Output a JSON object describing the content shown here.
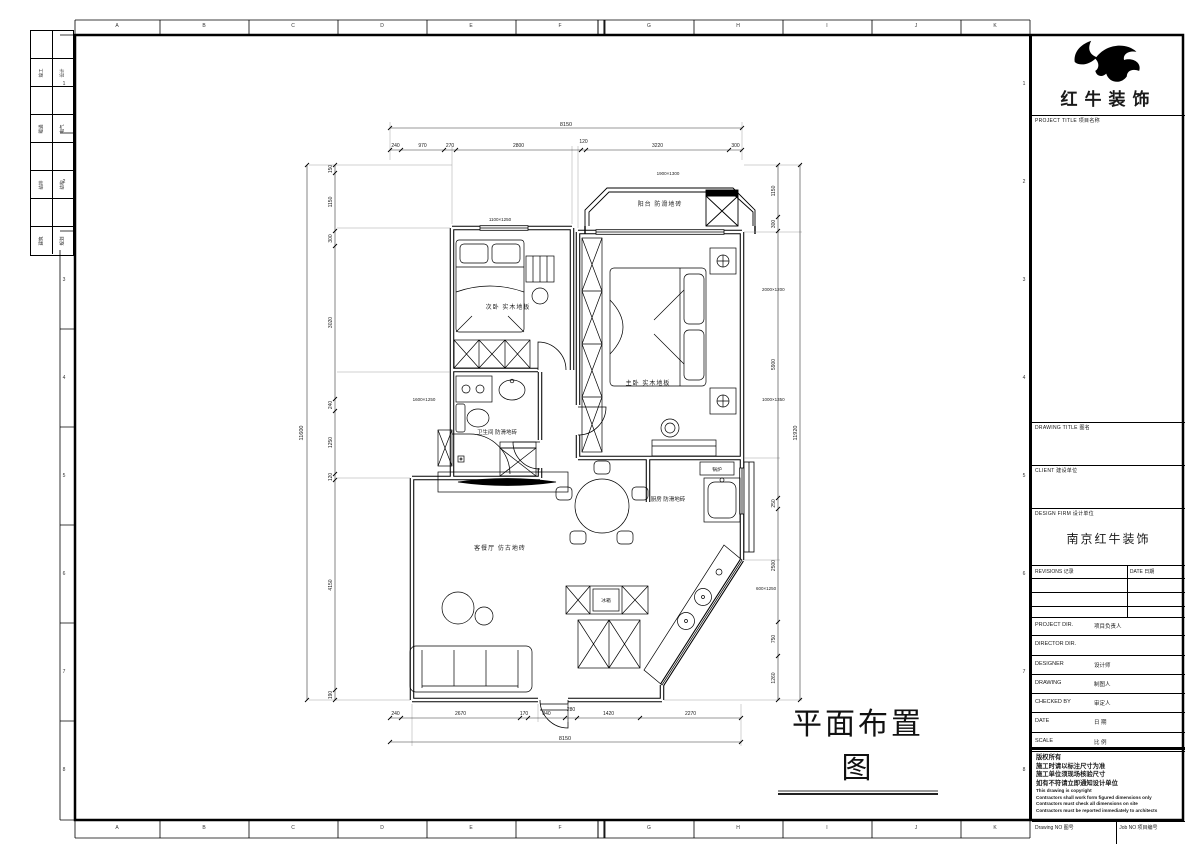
{
  "sheet": {
    "letters": [
      "A",
      "B",
      "C",
      "D",
      "E",
      "F",
      "G",
      "H",
      "I",
      "J",
      "K"
    ],
    "numbers": [
      "1",
      "2",
      "3",
      "4",
      "5",
      "6",
      "7",
      "8"
    ]
  },
  "strip": {
    "pairs": [
      {
        "a": "竣工",
        "b": "设计"
      },
      {
        "a": "暖通",
        "b": "电气"
      },
      {
        "a": "给排",
        "b": "结构"
      },
      {
        "a": "建筑",
        "b": "规划"
      }
    ]
  },
  "logo": {
    "company": "红牛装饰"
  },
  "titleblock": {
    "project_title": "PROJECT TITLE  项目名称",
    "drawing_title": "DRAWING TITLE  图名",
    "client": "CLIENT  建设单位",
    "design_firm": "DESIGN FIRM  设计单位",
    "design_firm_name": "南京红牛装饰",
    "revisions": "REVISIONS  记录",
    "date_col": "DATE  日期",
    "rows": [
      {
        "en": "PROJECT DIR.",
        "cn": "项目负责人"
      },
      {
        "en": "DIRECTOR DIR.",
        "cn": ""
      },
      {
        "en": "DESIGNER",
        "cn": "设计师"
      },
      {
        "en": "DRAWING",
        "cn": "制图人"
      },
      {
        "en": "CHECKED BY",
        "cn": "审定人"
      },
      {
        "en": "DATE",
        "cn": "日  期"
      },
      {
        "en": "SCALE",
        "cn": "比  例"
      }
    ],
    "notes": [
      "版权所有",
      "施工时请以标注尺寸为准",
      "施工单位须现场核验尺寸",
      "如有不符请立即通知设计单位",
      "This drawing is copyright",
      "Contractors shall work form figured dimensions only",
      "Contractors must check all dimensions on site",
      "Contractors must be reported immediately to architects"
    ],
    "drawing_no": "Drawing NO  图号",
    "job_no": "Job NO  项目编号"
  },
  "plan": {
    "title": "平面布置图",
    "rooms": {
      "balcony": "阳台  防滑地砖",
      "bedroom2": "次卧  实木地板",
      "bedroom1": "主卧  实木地板",
      "bathroom": "卫生间  防滑地砖",
      "kitchen": "厨房  防滑地砖",
      "living": "客餐厅  仿古地砖",
      "fridge": "冰箱",
      "boiler": "锅炉"
    },
    "small_dims": {
      "w1": "1100×1250",
      "bay": "1900×1300",
      "r1": "2000×1200",
      "r2": "1000×1350",
      "l1": "1600×1250",
      "k1": "600×1250"
    },
    "dims": {
      "top_overall": "8150",
      "top": [
        "240",
        "970",
        "270",
        "2800",
        "120",
        "3220",
        "300"
      ],
      "bottom": [
        "240",
        "2670",
        "170",
        "840",
        "280",
        "1420",
        "2270"
      ],
      "bottom_overall": "8150",
      "left_overall": "11600",
      "left": [
        "150",
        "1150",
        "300",
        "3020",
        "240",
        "1250",
        "120",
        "4150",
        "190"
      ],
      "right": [
        "1150",
        "300",
        "5900",
        "250",
        "2500",
        "750",
        "1260"
      ],
      "right_overall": "11920"
    }
  }
}
